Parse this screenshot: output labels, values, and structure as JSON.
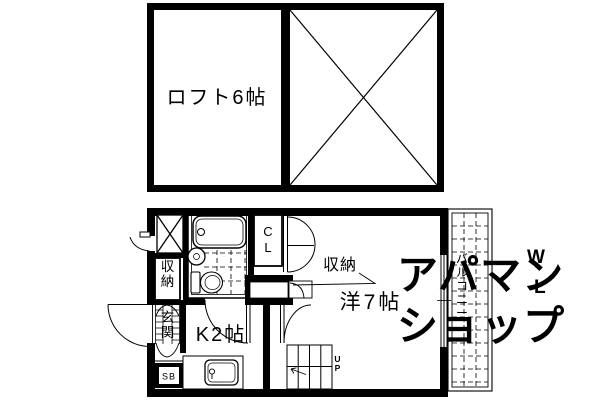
{
  "loft_plan": {
    "room_label": "ロフト6帖"
  },
  "main_plan": {
    "western_room_label": "洋7帖",
    "kitchen_label": "K2帖",
    "closet_label": "CL",
    "storage_box_label": "収納",
    "storage_callout_label": "収納",
    "entrance_label": "玄関",
    "shoe_box_label": "SB",
    "balcony_label": "バルコニー",
    "stairs_label": "UP"
  },
  "watermark": {
    "line1": "アパマン",
    "line2": "ショップ",
    "mark_w": "W",
    "mark_l": "L",
    "color": "#e3e3e3"
  },
  "colors": {
    "ink": "#000000",
    "background": "#ffffff"
  }
}
